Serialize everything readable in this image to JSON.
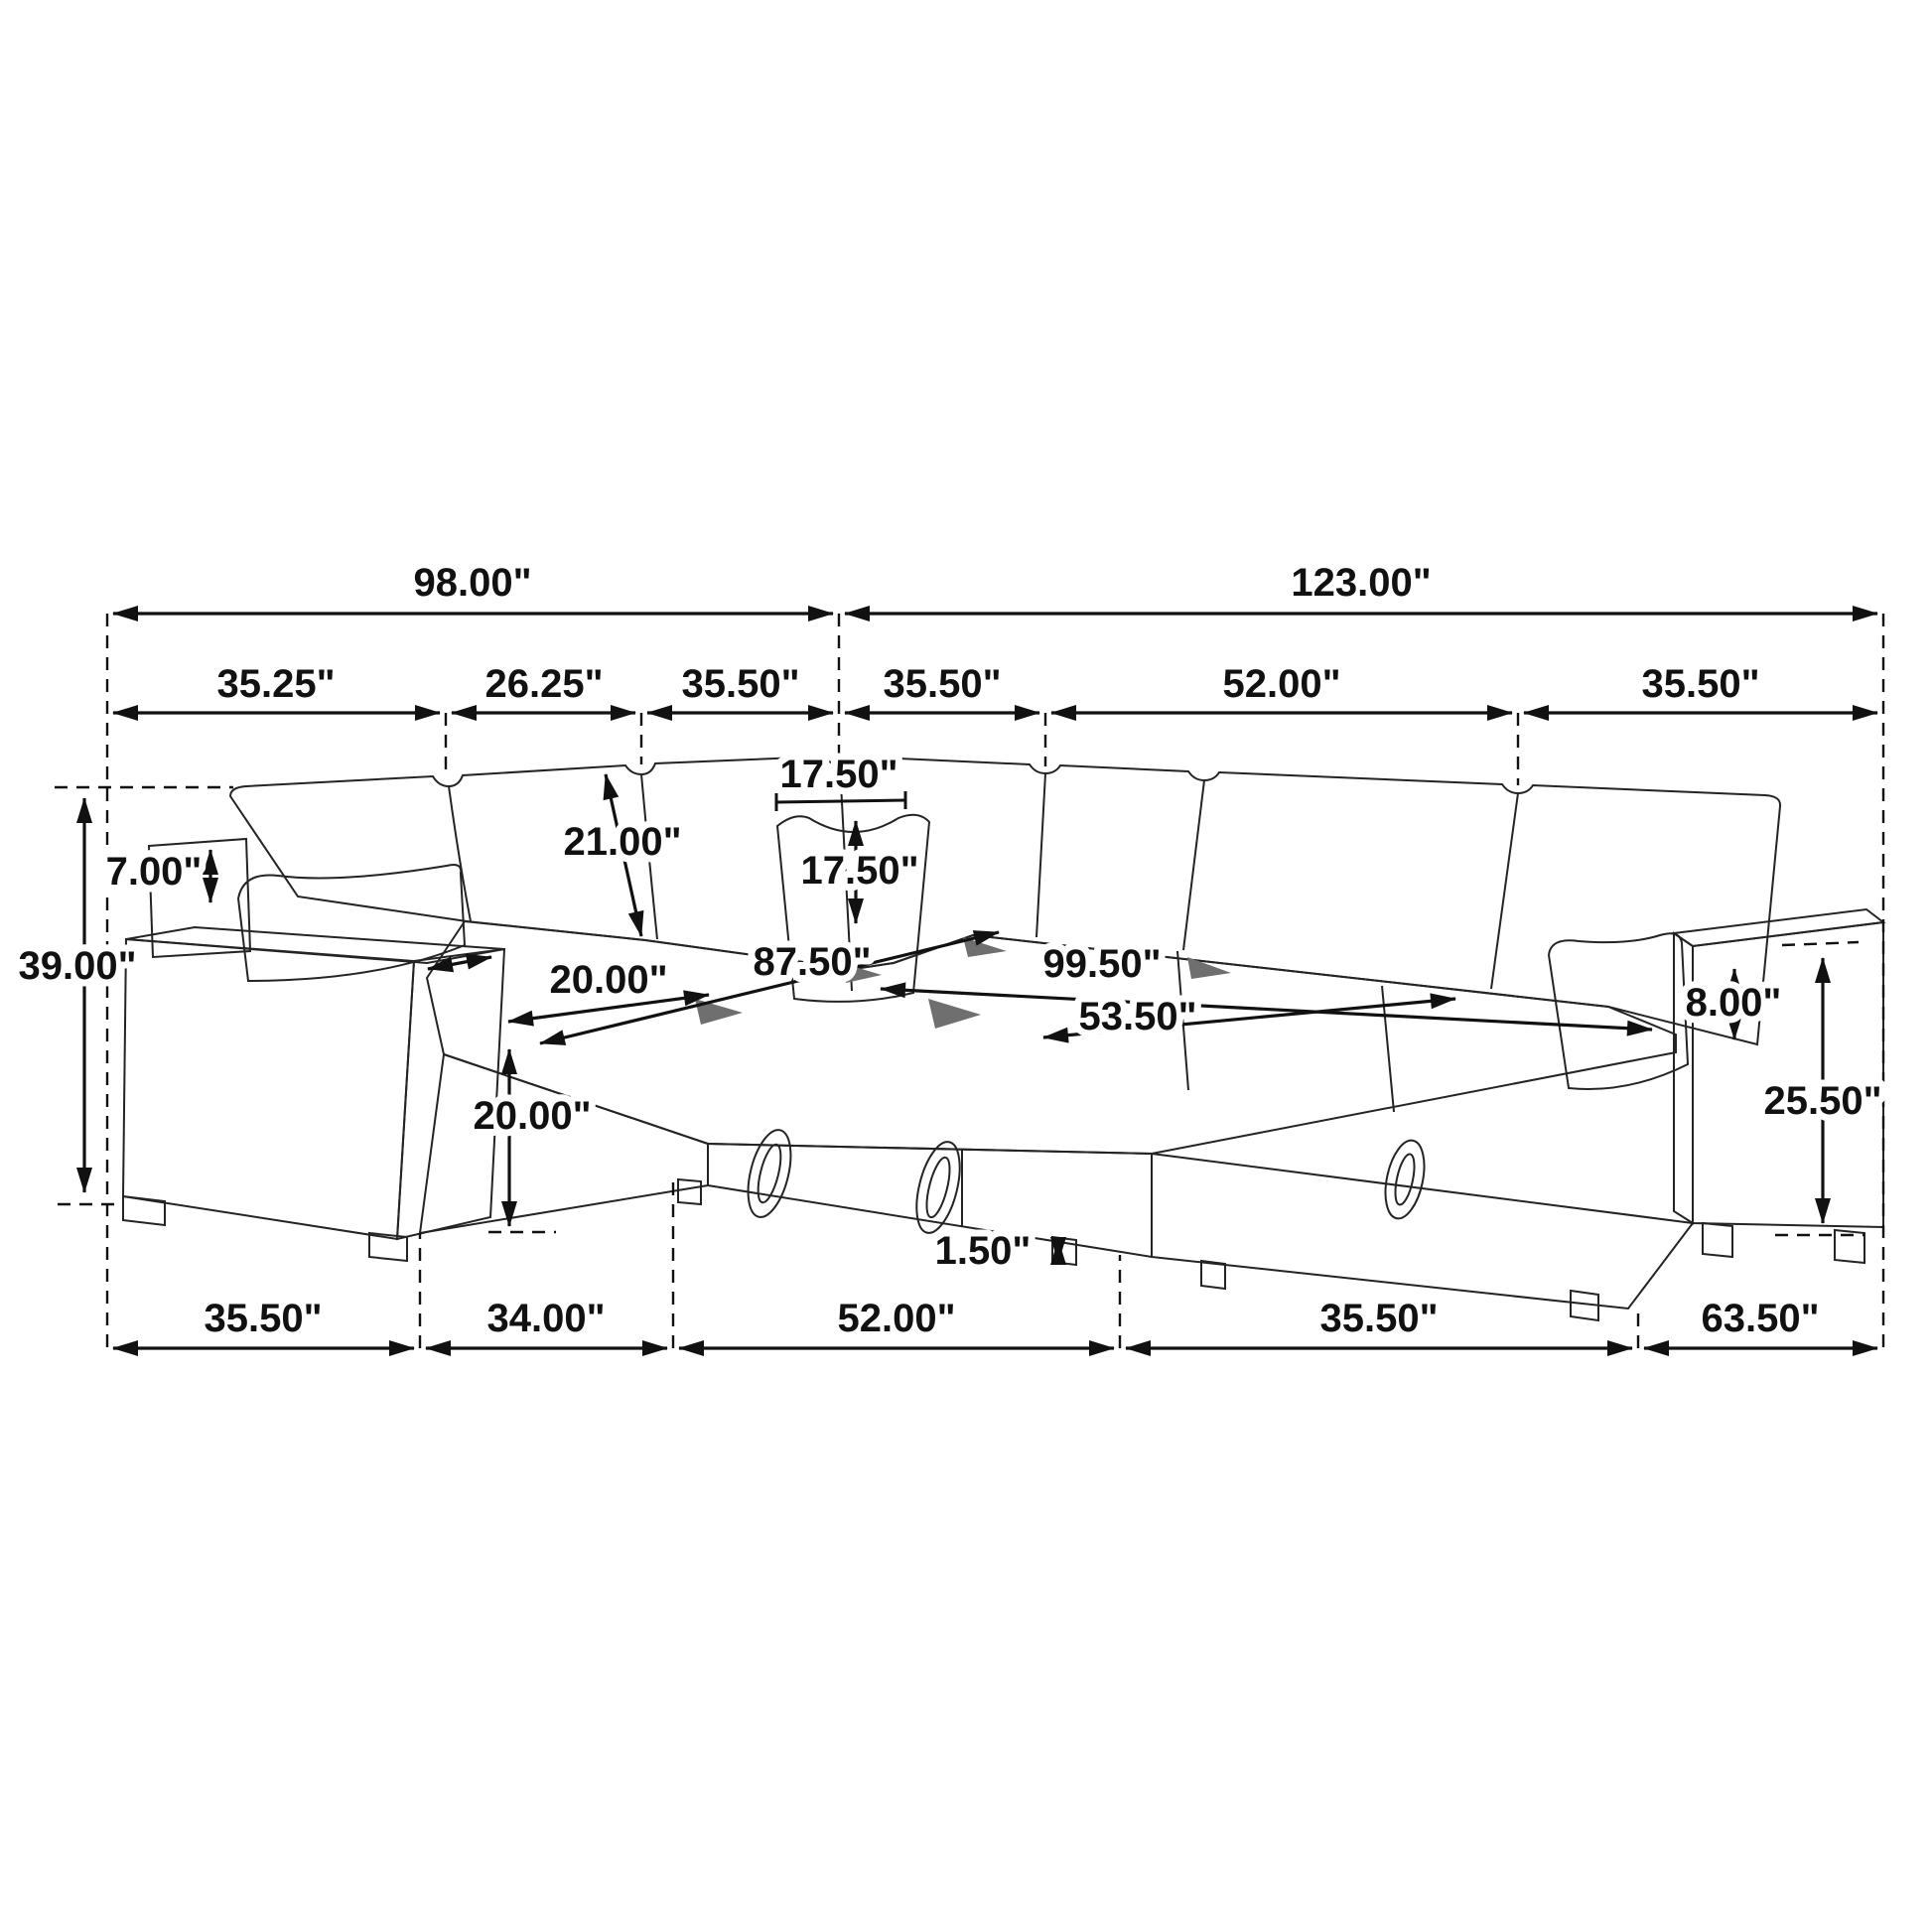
{
  "diagram": {
    "unit": "inches",
    "line_color": "#111111",
    "armrest_top_color": "#8f8f8f",
    "dimensions": {
      "overall_width_left": "98.00\"",
      "overall_width_right": "123.00\"",
      "top_segments": [
        "35.25\"",
        "26.25\"",
        "35.50\"",
        "35.50\"",
        "52.00\"",
        "35.50\""
      ],
      "bottom_segments": [
        "35.50\"",
        "34.00\"",
        "52.00\"",
        "35.50\"",
        "63.50\""
      ],
      "overall_height": "39.00\"",
      "back_pillow_rise": "7.00\"",
      "backrest_height": "21.00\"",
      "pillow_width": "17.50\"",
      "pillow_height": "17.50\"",
      "seat_walkway_depth": "20.00\"",
      "chaise_total_depth": "87.50\"",
      "bed_length": "99.50\"",
      "bed_width": "53.50\"",
      "armrest_above_seat": "8.00\"",
      "storage_base_height": "20.00\"",
      "arm_height": "25.50\"",
      "leg_clearance": "1.50\""
    }
  }
}
